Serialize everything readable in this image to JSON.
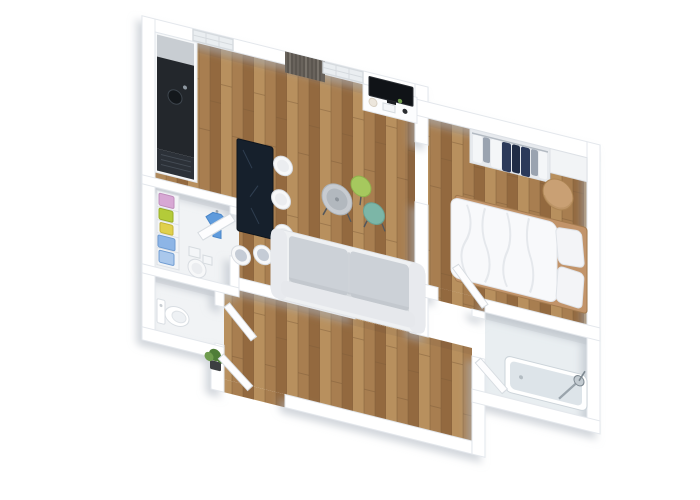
{
  "scene": {
    "title": "3D floor plan rendering of a one-bedroom apartment, top-down isometric view",
    "style": "photorealistic architectural render, white walls, oak parquet floors"
  },
  "colors": {
    "pageBackground": "#ffffff",
    "wall": "#ffffff",
    "wallStroke": "#e3e7ec",
    "wallShadow": "#aeb6bf",
    "wood": "#a87e50",
    "woodLight": "#b8905e",
    "woodDark": "#93693f",
    "woodSeam": "#7c5c38",
    "lightFloor": "#f1f3f5",
    "bathFloor": "#e9eef1",
    "floorShade": "#1c2733",
    "counterBase": "#f7f9fa",
    "counterSteel": "#c8cdd2",
    "counterTop": "#23272c",
    "sinkDark": "#14181c",
    "rack": "#2c3138",
    "rackLine": "#454c55",
    "tableNavy": "#16202c",
    "tableVein": "#46586f",
    "stoolFill": "#f7f8f9",
    "stoolStroke": "#d9dde2",
    "stoolSeat": "#ebedf0",
    "stoolSeatBlue": "#c5ccd6",
    "sofaBase": "#eff1f3",
    "sofaArm": "#e8eaee",
    "sofaCushion": "#ccd1d7",
    "sofaBack": "#e6e8ec",
    "sofaLine": "#b9bfc6",
    "tvBlack": "#101317",
    "tvStroke": "#2a2e33",
    "consoleFill": "#fcfdfe",
    "curtain": "#69635c",
    "curtainDark": "#524d46",
    "curtainLight": "#8a847c",
    "glass": "#eaeef1",
    "frame": "#d5dade",
    "doorLeaf": "#fdfdfe",
    "doorStroke": "#d7dce1",
    "wardrobeBack": "#e7eaee",
    "rail": "#b3bac2",
    "navyClothes": "#2c3a5a",
    "navyDark": "#202c45",
    "grayClothes": "#9aa3b0",
    "whiteClothes": "#f4f6f8",
    "bedFrame": "#c2946a",
    "bedFrameDark": "#a27a4e",
    "duvet": "#f8f9fb",
    "duvetLine": "#e2e5ea",
    "pillow": "#f3f4f7",
    "pillowStroke": "#dfe3e8",
    "pouf": "#c9a074",
    "poufDark": "#ad8554",
    "tub": "#ffffff",
    "tubInner": "#dde4e9",
    "tubStroke": "#ccd4da",
    "chrome": "#9aa4ac",
    "chromeDark": "#7d8890",
    "toiletStroke": "#d9dee3",
    "toiletInner": "#eef1f4",
    "shelf": "#f3f5f7",
    "shelfLine": "#dde1e6",
    "boxPink": "#d7a8d4",
    "boxPinkStroke": "#bf8dbb",
    "boxGreen": "#b4cb39",
    "boxGreenStroke": "#97ad25",
    "boxYellow": "#e0d04c",
    "boxYellowStroke": "#c4b439",
    "boxBlue": "#8db5e6",
    "boxBlueStroke": "#6f9cd2",
    "boxBlue2": "#aac8ec",
    "tshirt": "#5f9bdc",
    "tshirtDark": "#4a86c8",
    "plantGreen": "#4f7d38",
    "plantGreenLight": "#6f9c4e",
    "plantPot": "#3c3e41",
    "tableSilver": "#c7cbd0",
    "tableSilverIn": "#b2b8be",
    "tableGreen": "#a6c85e",
    "tableTeal": "#7cb6a7",
    "legDark": "#53575c",
    "itemPlate": "#ece6dc",
    "itemSpeaker": "#2a2d31"
  },
  "rooms": [
    {
      "id": "living-room",
      "objects": [
        "sofa",
        "coffee-table-silver",
        "coffee-table-green",
        "coffee-table-teal",
        "tv-console",
        "tv-screen",
        "window",
        "curtain-panel"
      ]
    },
    {
      "id": "kitchen",
      "objects": [
        "kitchen-counter",
        "steel-worktop",
        "dark-countertop",
        "sink",
        "window"
      ]
    },
    {
      "id": "dining-area",
      "objects": [
        "navy-dining-table",
        "white-stool",
        "white-stool",
        "white-stool",
        "white-stool",
        "white-stool"
      ]
    },
    {
      "id": "walk-in-closet",
      "objects": [
        "shelf-unit",
        "pink-box",
        "green-box",
        "yellow-box",
        "blue-bin",
        "blue-bin",
        "hanging-t-shirt",
        "stool",
        "floor-boxes",
        "door"
      ]
    },
    {
      "id": "wc",
      "objects": [
        "toilet",
        "door"
      ]
    },
    {
      "id": "hallway",
      "objects": [
        "potted-plant",
        "entrance-door"
      ]
    },
    {
      "id": "bedroom",
      "objects": [
        "double-bed",
        "duvet",
        "pillow",
        "pillow",
        "wood-bed-frame",
        "round-pouf",
        "open-wardrobe",
        "hanging-clothes",
        "door"
      ]
    },
    {
      "id": "bathroom",
      "objects": [
        "shower-tub",
        "shower-fixture",
        "door"
      ]
    }
  ]
}
